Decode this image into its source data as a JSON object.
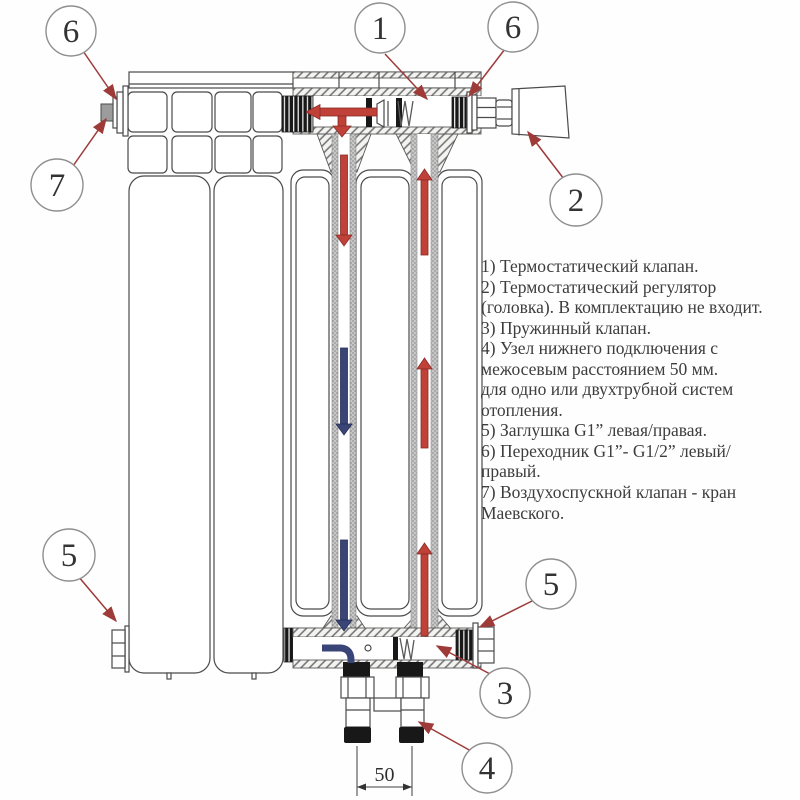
{
  "callouts": [
    {
      "id": "adapter-top-left",
      "label": "6"
    },
    {
      "id": "air-vent",
      "label": "7"
    },
    {
      "id": "thermo-valve",
      "label": "1"
    },
    {
      "id": "adapter-top-right",
      "label": "6"
    },
    {
      "id": "thermo-head",
      "label": "2"
    },
    {
      "id": "plug-bottom-left",
      "label": "5"
    },
    {
      "id": "plug-bottom-right",
      "label": "5"
    },
    {
      "id": "spring-valve",
      "label": "3"
    },
    {
      "id": "bottom-connection",
      "label": "4"
    }
  ],
  "dimension": {
    "label": "50"
  },
  "legend": {
    "lines": [
      "1) Термостатический клапан.",
      "2) Термостатический регулятор",
      "(головка). В комплектацию не входит.",
      "3) Пружинный клапан.",
      "4) Узел нижнего подключения с",
      "межосевым расстоянием 50 мм.",
      "для одно или двухтрубной систем",
      "отопления.",
      "5) Заглушка G1” левая/правая.",
      "6) Переходник G1”- G1/2” левый/",
      "правый.",
      "7) Воздухоспускной клапан - кран",
      "Маевского."
    ]
  },
  "colors": {
    "flow_hot": "#bf4138",
    "flow_return": "#3a4577",
    "callout_arrow": "#9e3a38",
    "outline": "#4a4a4a",
    "text": "#3d3d3d"
  }
}
